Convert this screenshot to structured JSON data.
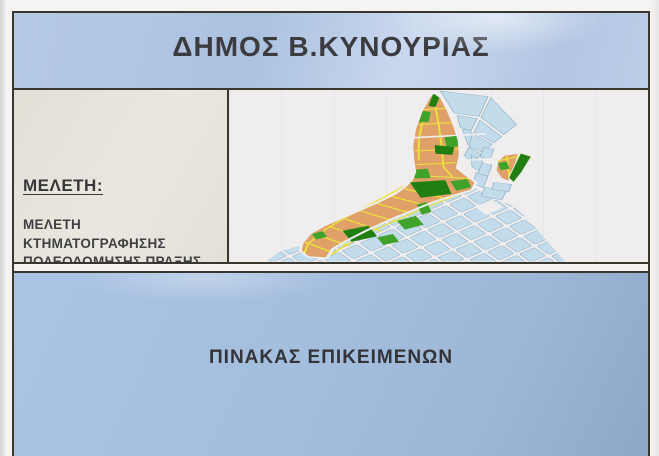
{
  "header": {
    "title": "ΔΗΜΟΣ Β.ΚΥΝΟΥΡΙΑΣ"
  },
  "study": {
    "heading": "ΜΕΛΕΤΗ:",
    "lines": [
      "ΜΕΛΕΤΗ",
      "ΚΤΗΜΑΤΟΓΡΑΦΗΣΗΣ",
      "ΠΟΛΕΟΔΟΜΗΣΗΣ ΠΡΑΞΗΣ",
      "ΕΦΑΡΜΟΓΗΣ ΠΕΡΙΟΧΗΣ Α",
      "ΚΑΤΟΙΚΙΑΣ ΚΟΙΝΟΤΗΤΑΣ",
      "ΠΑΡΑΛΙΟΥ ΑΣΤΡΟΥΣ"
    ]
  },
  "footer": {
    "title": "ΠΙΝΑΚΑΣ ΕΠΙΚΕΙΜΕΝΩΝ"
  },
  "map": {
    "colors": {
      "background": "#efedee",
      "planned_blocks": "#dfa167",
      "street_lines": "#e9e33a",
      "green_spaces": "#3fa32a",
      "green_spaces_dark": "#217f12",
      "existing_blocks": "#c3dcec",
      "existing_outline": "#8fb0c4",
      "frame": "#3a372f"
    },
    "layers": [
      {
        "name": "survey-grid",
        "type": "rect",
        "attrs": {
          "x": 0,
          "y": 0,
          "width": 424,
          "height": 312,
          "fill": "url(#surveygrid)"
        }
      },
      {
        "name": "existing-town-grid",
        "type": "polygon",
        "attrs": {
          "points": "238,170 262,190 290,214 302,234 340,312 38,312 50,295 66,286 80,280 100,262 124,238 158,214 190,191 214,179",
          "fill": "url(#cityblocks)"
        }
      },
      {
        "name": "plaza-hole",
        "type": "rect",
        "attrs": {
          "x": 253,
          "y": 206,
          "width": 22,
          "height": 16,
          "fill": "#efedee",
          "transform": "rotate(-38 264 214)"
        }
      },
      {
        "name": "existing-block",
        "type": "polygon",
        "attrs": {
          "points": "214,2 262,12 253,48 228,42",
          "fill": "#c3dcec",
          "stroke": "#8fb0c4",
          "stroke-width": "0.8"
        }
      },
      {
        "name": "existing-block",
        "type": "polygon",
        "attrs": {
          "points": "265,14 291,63 278,81 255,50",
          "fill": "#c3dcec",
          "stroke": "#8fb0c4",
          "stroke-width": "0.8"
        }
      },
      {
        "name": "existing-block",
        "type": "polygon",
        "attrs": {
          "points": "231,46 251,52 245,74 234,68",
          "fill": "#c3dcec",
          "stroke": "#8fb0c4",
          "stroke-width": "0.8"
        }
      },
      {
        "name": "existing-block",
        "type": "polygon",
        "attrs": {
          "points": "254,55 276,85 268,96 248,77",
          "fill": "#c3dcec",
          "stroke": "#8fb0c4",
          "stroke-width": "0.8"
        }
      },
      {
        "name": "existing-block",
        "type": "polygon",
        "attrs": {
          "points": "236,71 244,74 250,96 242,100",
          "fill": "#c3dcec",
          "stroke": "#8fb0c4",
          "stroke-width": "0.8"
        }
      },
      {
        "name": "existing-block",
        "type": "polygon",
        "attrs": {
          "points": "246,79 266,98 257,114 243,102",
          "fill": "#c3dcec",
          "stroke": "#8fb0c4",
          "stroke-width": "0.8"
        }
      },
      {
        "name": "existing-block",
        "type": "polygon",
        "attrs": {
          "points": "243,104 255,117 247,131 238,119",
          "fill": "#c3dcec",
          "stroke": "#8fb0c4",
          "stroke-width": "0.8"
        }
      },
      {
        "name": "existing-block",
        "type": "polygon",
        "attrs": {
          "points": "245,118 257,130 254,148 246,140",
          "fill": "#c3dcec",
          "stroke": "#8fb0c4",
          "stroke-width": "0.8"
        }
      },
      {
        "name": "existing-block",
        "type": "polygon",
        "attrs": {
          "points": "250,150 262,158 257,178 247,170",
          "fill": "#c3dcec",
          "stroke": "#8fb0c4",
          "stroke-width": "0.8"
        }
      },
      {
        "name": "existing-block",
        "type": "polygon",
        "attrs": {
          "points": "258,104 268,108 264,126 254,122",
          "fill": "#c3dcec",
          "stroke": "#8fb0c4",
          "stroke-width": "0.8"
        }
      },
      {
        "name": "existing-block",
        "type": "polygon",
        "attrs": {
          "points": "256,133 266,137 262,156 252,152",
          "fill": "#c3dcec",
          "stroke": "#8fb0c4",
          "stroke-width": "0.8"
        }
      },
      {
        "name": "existing-block",
        "type": "polygon",
        "attrs": {
          "points": "259,177 281,183 276,200 255,193",
          "fill": "#c3dcec",
          "stroke": "#8fb0c4",
          "stroke-width": "0.8"
        }
      },
      {
        "name": "existing-block",
        "type": "polygon",
        "attrs": {
          "points": "268,168 286,172 283,185 266,181",
          "fill": "#c3dcec",
          "stroke": "#8fb0c4",
          "stroke-width": "0.8"
        }
      },
      {
        "name": "planned-area",
        "type": "polygon",
        "attrs": {
          "points": "207,4 215,14 222,38 228,64 233,92 234,118 231,142 241,156 250,168 246,182 229,191 208,203 186,219 163,236 140,255 118,275 105,289 99,306 80,304 72,292 74,278 82,261 97,246 115,232 133,218 152,203 168,189 178,176 185,162 188,149 186,128 185,100 188,70 194,40 202,14",
          "fill": "#dfa167"
        }
      },
      {
        "name": "street",
        "type": "line",
        "attrs": {
          "x1": 197,
          "y1": 36,
          "x2": 222,
          "y2": 33,
          "stroke": "#e9e33a",
          "stroke-width": "2"
        }
      },
      {
        "name": "street",
        "type": "line",
        "attrs": {
          "x1": 192,
          "y1": 63,
          "x2": 228,
          "y2": 59,
          "stroke": "#e9e33a",
          "stroke-width": "2"
        }
      },
      {
        "name": "street",
        "type": "line",
        "attrs": {
          "x1": 188,
          "y1": 111,
          "x2": 232,
          "y2": 107,
          "stroke": "#e9e33a",
          "stroke-width": "2"
        }
      },
      {
        "name": "street",
        "type": "line",
        "attrs": {
          "x1": 190,
          "y1": 136,
          "x2": 229,
          "y2": 132,
          "stroke": "#e9e33a",
          "stroke-width": "2"
        }
      },
      {
        "name": "street",
        "type": "polyline",
        "attrs": {
          "points": "207,15 212,60 215,100 217,140 226,158",
          "fill": "none",
          "stroke": "#e9e33a",
          "stroke-width": "2"
        }
      },
      {
        "name": "street",
        "type": "polyline",
        "attrs": {
          "points": "198,42 192,90 192,128",
          "fill": "none",
          "stroke": "#e9e33a",
          "stroke-width": "2"
        }
      },
      {
        "name": "street",
        "type": "line",
        "attrs": {
          "x1": 188,
          "y1": 155,
          "x2": 243,
          "y2": 161,
          "stroke": "#e9e33a",
          "stroke-width": "2"
        }
      },
      {
        "name": "street",
        "type": "line",
        "attrs": {
          "x1": 178,
          "y1": 180,
          "x2": 216,
          "y2": 196,
          "stroke": "#e9e33a",
          "stroke-width": "2"
        }
      },
      {
        "name": "street",
        "type": "line",
        "attrs": {
          "x1": 164,
          "y1": 193,
          "x2": 201,
          "y2": 211,
          "stroke": "#e9e33a",
          "stroke-width": "2"
        }
      },
      {
        "name": "street",
        "type": "line",
        "attrs": {
          "x1": 149,
          "y1": 206,
          "x2": 186,
          "y2": 225,
          "stroke": "#e9e33a",
          "stroke-width": "2"
        }
      },
      {
        "name": "street",
        "type": "line",
        "attrs": {
          "x1": 133,
          "y1": 220,
          "x2": 170,
          "y2": 240,
          "stroke": "#e9e33a",
          "stroke-width": "2"
        }
      },
      {
        "name": "street",
        "type": "line",
        "attrs": {
          "x1": 117,
          "y1": 234,
          "x2": 154,
          "y2": 257,
          "stroke": "#e9e33a",
          "stroke-width": "2"
        }
      },
      {
        "name": "street",
        "type": "line",
        "attrs": {
          "x1": 101,
          "y1": 248,
          "x2": 138,
          "y2": 270,
          "stroke": "#e9e33a",
          "stroke-width": "2"
        }
      },
      {
        "name": "street",
        "type": "line",
        "attrs": {
          "x1": 87,
          "y1": 262,
          "x2": 122,
          "y2": 284,
          "stroke": "#e9e33a",
          "stroke-width": "2"
        }
      },
      {
        "name": "street",
        "type": "line",
        "attrs": {
          "x1": 77,
          "y1": 277,
          "x2": 107,
          "y2": 297,
          "stroke": "#e9e33a",
          "stroke-width": "2"
        }
      },
      {
        "name": "street",
        "type": "polyline",
        "attrs": {
          "points": "186,166 158,194 128,222 99,252 80,280 76,298",
          "fill": "none",
          "stroke": "#e9e33a",
          "stroke-width": "2"
        }
      },
      {
        "name": "street",
        "type": "polyline",
        "attrs": {
          "points": "240,185 210,206 178,230 146,256 120,280 103,300",
          "fill": "none",
          "stroke": "#e9e33a",
          "stroke-width": "2"
        }
      },
      {
        "name": "main-road",
        "type": "line",
        "attrs": {
          "x1": 184,
          "y1": 87,
          "x2": 260,
          "y2": 80,
          "stroke": "#efedee",
          "stroke-width": "3"
        }
      },
      {
        "name": "main-road",
        "type": "line",
        "attrs": {
          "x1": 232,
          "y1": 129,
          "x2": 266,
          "y2": 125,
          "stroke": "#efedee",
          "stroke-width": "3"
        }
      },
      {
        "name": "green-space",
        "type": "polygon",
        "attrs": {
          "points": "207,5 213,13 209,31 202,29",
          "fill": "#217f12"
        }
      },
      {
        "name": "green-space",
        "type": "polygon",
        "attrs": {
          "points": "196,38 204,40 202,58 192,59",
          "fill": "#3fa32a"
        }
      },
      {
        "name": "green-space",
        "type": "polygon",
        "attrs": {
          "points": "218,86 232,83 234,102 220,104",
          "fill": "#3fa32a"
        }
      },
      {
        "name": "green-space",
        "type": "polygon",
        "attrs": {
          "points": "208,100 228,104 226,118 209,116",
          "fill": "#217f12"
        }
      },
      {
        "name": "green-space",
        "type": "polygon",
        "attrs": {
          "points": "187,145 201,143 204,160 188,161",
          "fill": "#3fa32a"
        }
      },
      {
        "name": "green-space",
        "type": "polygon",
        "attrs": {
          "points": "183,168 219,164 225,189 194,196",
          "fill": "#217f12"
        }
      },
      {
        "name": "green-space",
        "type": "polygon",
        "attrs": {
          "points": "224,166 241,162 245,177 230,183",
          "fill": "#3fa32a"
        }
      },
      {
        "name": "green-space",
        "type": "polygon",
        "attrs": {
          "points": "170,238 189,229 197,245 178,254",
          "fill": "#3fa32a"
        }
      },
      {
        "name": "green-space",
        "type": "polygon",
        "attrs": {
          "points": "115,256 141,247 150,266 124,276",
          "fill": "#217f12"
        }
      },
      {
        "name": "green-space",
        "type": "polygon",
        "attrs": {
          "points": "84,262 95,257 99,267 88,272",
          "fill": "#3fa32a"
        }
      },
      {
        "name": "green-space",
        "type": "polygon",
        "attrs": {
          "points": "190,208 200,204 205,222 195,227",
          "fill": "#3fa32a"
        }
      },
      {
        "name": "green-space",
        "type": "polygon",
        "attrs": {
          "points": "150,268 166,262 172,276 156,282",
          "fill": "#3fa32a"
        }
      },
      {
        "name": "planned-area-outline",
        "type": "polygon",
        "attrs": {
          "points": "207,4 215,14 222,38 228,64 233,92 234,118 231,142 241,156 250,168 246,182 229,191 208,203 186,219 163,236 140,255 118,275 105,289 99,306 80,304 72,292 74,278 82,261 97,246 115,232 133,218 152,203 168,189 178,176 185,162 188,149 186,128 185,100 188,70 194,40 202,14",
          "fill": "none",
          "stroke": "#efedee",
          "stroke-width": "3",
          "stroke-linejoin": "round"
        }
      },
      {
        "name": "planned-annex",
        "type": "polygon",
        "attrs": {
          "points": "272,130 278,119 293,115 288,148 283,166 275,160 270,146",
          "fill": "#dfa167",
          "stroke": "#efedee",
          "stroke-width": "1.5"
        }
      },
      {
        "name": "street",
        "type": "line",
        "attrs": {
          "x1": 272,
          "y1": 129,
          "x2": 295,
          "y2": 120,
          "stroke": "#e9e33a",
          "stroke-width": "2"
        }
      },
      {
        "name": "street",
        "type": "line",
        "attrs": {
          "x1": 281,
          "y1": 120,
          "x2": 284,
          "y2": 162,
          "stroke": "#e9e33a",
          "stroke-width": "2"
        }
      },
      {
        "name": "street",
        "type": "line",
        "attrs": {
          "x1": 302,
          "y1": 118,
          "x2": 306,
          "y2": 125,
          "stroke": "#e9e33a",
          "stroke-width": "2"
        }
      },
      {
        "name": "green-space",
        "type": "polygon",
        "attrs": {
          "points": "272,133 281,130 284,143 275,146",
          "fill": "#3fa32a"
        }
      },
      {
        "name": "green-space",
        "type": "polygon",
        "attrs": {
          "points": "295,115 306,121 296,150 288,168 283,160 289,137",
          "fill": "#217f12",
          "stroke": "#efedee",
          "stroke-width": "1"
        }
      }
    ]
  }
}
